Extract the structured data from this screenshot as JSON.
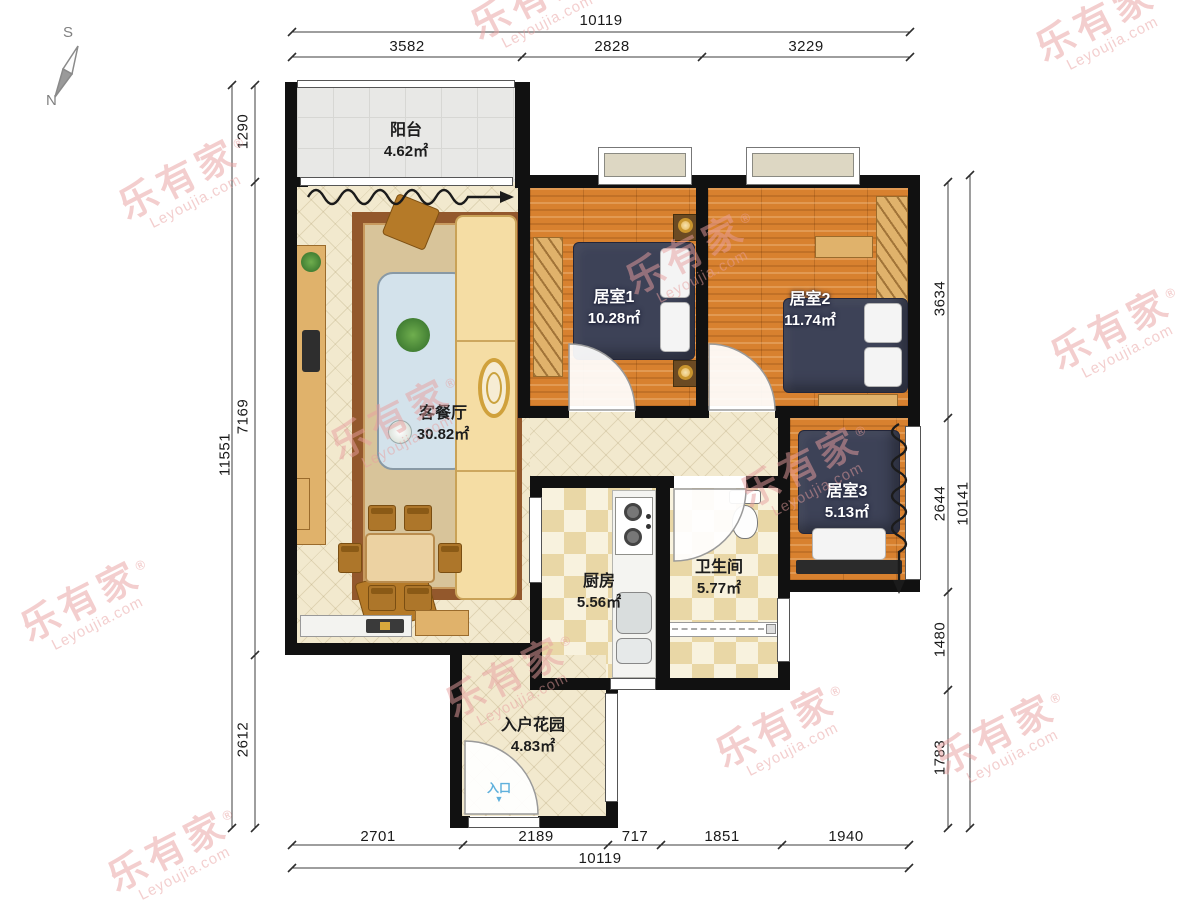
{
  "title": "residential floor plan",
  "compass": {
    "south_label": "S",
    "north_label": "N"
  },
  "watermark": {
    "brand": "乐有家",
    "reg": "®",
    "domain": "Leyoujia.com",
    "color": "#e89f9f"
  },
  "rooms": [
    {
      "id": "balcony",
      "name": "阳台",
      "area": "4.62㎡"
    },
    {
      "id": "living-dining",
      "name": "客餐厅",
      "area": "30.82㎡"
    },
    {
      "id": "bedroom-1",
      "name": "居室1",
      "area": "10.28㎡"
    },
    {
      "id": "bedroom-2",
      "name": "居室2",
      "area": "11.74㎡"
    },
    {
      "id": "bedroom-3",
      "name": "居室3",
      "area": "5.13㎡"
    },
    {
      "id": "kitchen",
      "name": "厨房",
      "area": "5.56㎡"
    },
    {
      "id": "bathroom",
      "name": "卫生间",
      "area": "5.77㎡"
    },
    {
      "id": "entry-garden",
      "name": "入户花园",
      "area": "4.83㎡"
    }
  ],
  "entrance": {
    "label": "入口",
    "arrow": "▼"
  },
  "dimensions": {
    "top": {
      "total": "10119",
      "segments": [
        "3582",
        "2828",
        "3229"
      ]
    },
    "bottom": {
      "total": "10119",
      "segments": [
        "2701",
        "2189",
        "717",
        "1851",
        "1940"
      ]
    },
    "left": {
      "total": "11551",
      "segments": [
        "1290",
        "7169",
        "2612"
      ]
    },
    "right": {
      "total": "10141",
      "segments": [
        "3634",
        "2644",
        "1480",
        "1783"
      ]
    }
  },
  "colors": {
    "wall": "#111111",
    "wood_floor": "#d8812f",
    "tile_cream": "#f2e9ce",
    "tile_checker": "#e9d7a6",
    "balcony_gray": "#e8e8e6",
    "bed_navy": "#3d4257",
    "watermark_pink": "#e89f9f",
    "entry_blue": "#5fb0dc"
  },
  "furniture_icons": [
    "sofa-icon",
    "rug-icon",
    "coffee-table-icon",
    "armchair-icon",
    "floor-lamp-icon",
    "tv-console-icon",
    "dining-table-icon",
    "chair-icon",
    "sideboard-icon",
    "wardrobe-icon",
    "bed-icon",
    "nightstand-icon",
    "desk-icon",
    "bench-icon",
    "stove-icon",
    "sink-icon",
    "toilet-icon",
    "shower-screen-icon",
    "plant-icon"
  ]
}
